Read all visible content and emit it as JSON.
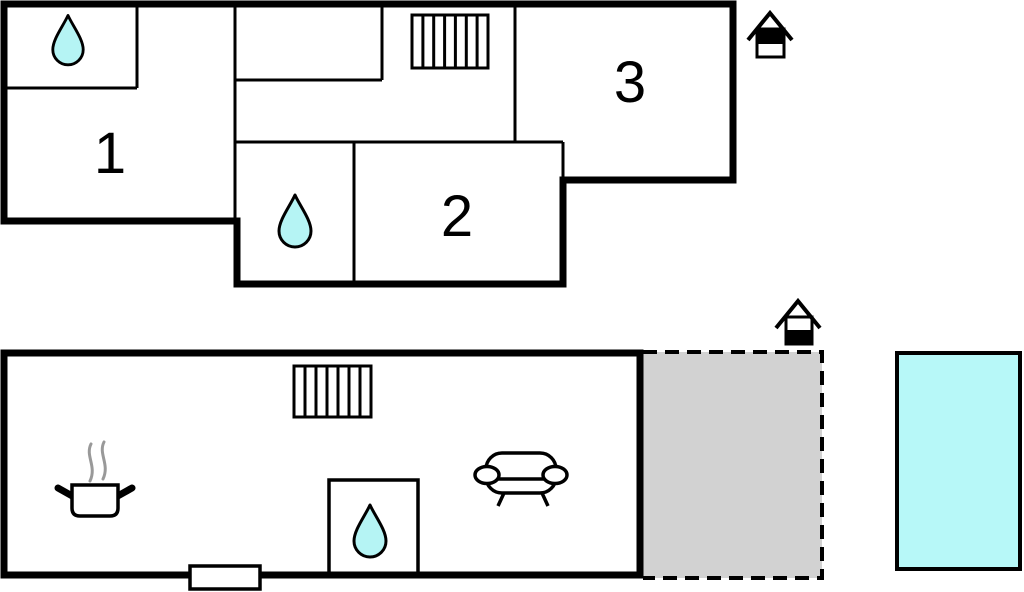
{
  "diagram": {
    "type": "floor-plan",
    "floors": [
      {
        "name": "upper-floor",
        "rooms": [
          {
            "label": "1"
          },
          {
            "label": "2"
          },
          {
            "label": "3"
          }
        ],
        "icons": [
          "water-drop-icon",
          "water-drop-icon",
          "stairs-icon",
          "floor-level-indicator-icon"
        ]
      },
      {
        "name": "ground-floor",
        "rooms": [],
        "icons": [
          "stairs-icon",
          "water-drop-icon",
          "stove-pot-icon",
          "steam-icon",
          "sofa-icon",
          "entrance-door",
          "floor-level-indicator-icon"
        ]
      }
    ],
    "outdoor": [
      "terrace",
      "pool"
    ]
  },
  "labels": {
    "room1": "1",
    "room2": "2",
    "room3": "3"
  },
  "colors": {
    "wall": "#000000",
    "water_fill": "#b5f4f4",
    "pool_fill": "#b7f8f8",
    "terrace_fill": "#d2d2d2",
    "steam": "#999999",
    "background": "#ffffff"
  }
}
